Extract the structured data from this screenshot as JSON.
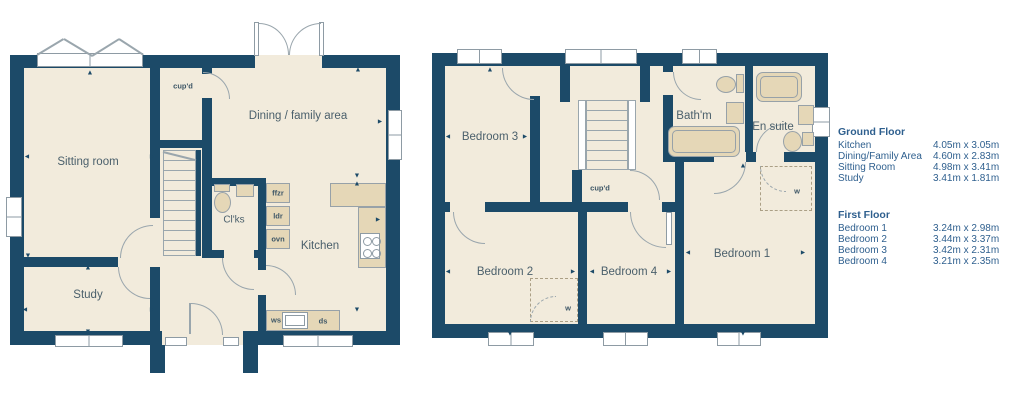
{
  "colors": {
    "wall": "#1c4a68",
    "floor": "#f2ebdc",
    "fixture": "#e5d7b7",
    "line": "#9aa6ad",
    "ink": "#4a5f6b",
    "legend": "#2e5f8e"
  },
  "markers": {
    "up": "▲",
    "down": "▼",
    "left": "◄",
    "right": "►"
  },
  "ground_floor": {
    "rooms": {
      "sitting_room": "Sitting room",
      "study": "Study",
      "cupboard": "cup'd",
      "dining": "Dining / family area",
      "cloakroom": "Cl'ks",
      "kitchen": "Kitchen"
    },
    "fixtures": {
      "freezer": "ffzr",
      "larder": "ldr",
      "oven": "ovn",
      "worktop": "ws",
      "dishwasher": "ds"
    }
  },
  "first_floor": {
    "rooms": {
      "bedroom1": "Bedroom 1",
      "bedroom2": "Bedroom 2",
      "bedroom3": "Bedroom 3",
      "bedroom4": "Bedroom 4",
      "bathroom": "Bath'm",
      "ensuite": "En suite",
      "cupboard": "cup'd",
      "wardrobe": "w"
    }
  },
  "legend": {
    "ground_floor": {
      "title": "Ground Floor",
      "rows": [
        {
          "room": "Kitchen",
          "size": "4.05m x 3.05m"
        },
        {
          "room": "Dining/Family Area",
          "size": "4.60m x 2.83m"
        },
        {
          "room": "Sitting Room",
          "size": "4.98m x 3.41m"
        },
        {
          "room": "Study",
          "size": "3.41m x 1.81m"
        }
      ]
    },
    "first_floor": {
      "title": "First Floor",
      "rows": [
        {
          "room": "Bedroom 1",
          "size": "3.24m x 2.98m"
        },
        {
          "room": "Bedroom 2",
          "size": "3.44m x 3.37m"
        },
        {
          "room": "Bedroom 3",
          "size": "3.42m x 2.31m"
        },
        {
          "room": "Bedroom 4",
          "size": "3.21m x 2.35m"
        }
      ]
    }
  }
}
